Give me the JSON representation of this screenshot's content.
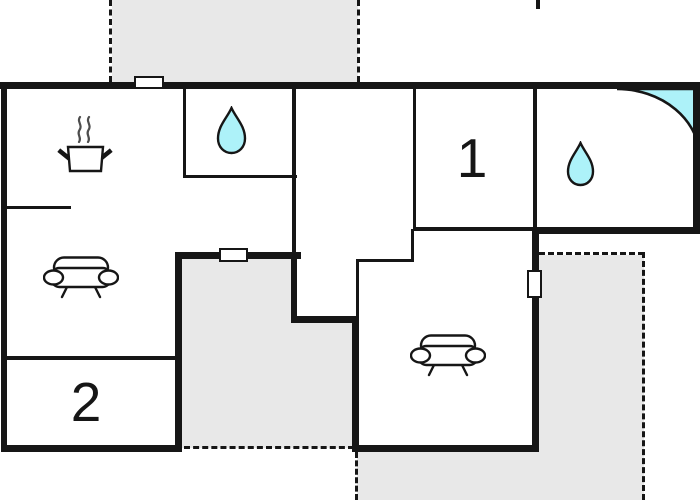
{
  "floor_plan": {
    "name": "apartment-floor-plan",
    "rooms": {
      "room1": {
        "label": "1"
      },
      "room2": {
        "label": "2"
      }
    },
    "icons": [
      "stove-pot-icon",
      "water-drop-icon (top-middle bathroom)",
      "water-drop-icon (right bathroom)",
      "corner-shower-icon",
      "sofa-icon (left living room)",
      "sofa-icon (right living room)",
      "window (top wall)",
      "window (courtyard wall)",
      "window (right living room wall)"
    ],
    "terraces": [
      "terrace-top",
      "courtyard-middle",
      "terrace-bottom-right"
    ]
  },
  "theme": {
    "bg": "#ffffff",
    "wall": "#161616",
    "terrace_fill": "#e8e8e8",
    "water_fill": "#adf2f9",
    "icon_stroke": "#161616",
    "steam": "#4d4d4d"
  }
}
